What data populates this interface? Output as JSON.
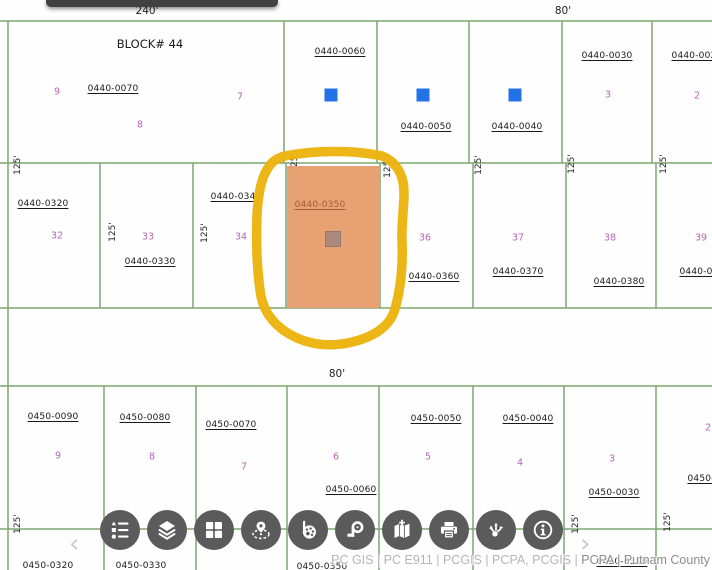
{
  "map": {
    "colors": {
      "line": "#7da671",
      "lot_number": "#b666b6",
      "structure_blue": "#2473e6",
      "highlight_fill": "#e7a173",
      "highlight_label": "#a65c36",
      "highlight_inner_square": "#aa8a7e",
      "marker_yellow": "#ebb40e",
      "toolbar_button": "#5b5b5b",
      "topbar": "#414141"
    },
    "block_label": {
      "text": "BLOCK# 44",
      "x": 150,
      "y": 44
    },
    "dimension_labels": [
      {
        "text": "240'",
        "x": 147,
        "y": 11
      },
      {
        "text": "80'",
        "x": 563,
        "y": 11
      },
      {
        "text": "80'",
        "x": 337,
        "y": 374
      }
    ],
    "tick_text": "125'",
    "ticks": [
      {
        "x": 18,
        "y": 165
      },
      {
        "x": 295,
        "y": 163
      },
      {
        "x": 388,
        "y": 168
      },
      {
        "x": 479,
        "y": 165
      },
      {
        "x": 572,
        "y": 164
      },
      {
        "x": 664,
        "y": 164
      },
      {
        "x": 113,
        "y": 232
      },
      {
        "x": 205,
        "y": 233
      },
      {
        "x": 18,
        "y": 524
      },
      {
        "x": 576,
        "y": 524
      },
      {
        "x": 668,
        "y": 522
      }
    ],
    "parcel_id_labels": [
      {
        "text": "0440-0070",
        "x": 113,
        "y": 89
      },
      {
        "text": "0440-0060",
        "x": 340,
        "y": 52
      },
      {
        "text": "0440-0050",
        "x": 426,
        "y": 127
      },
      {
        "text": "0440-0040",
        "x": 517,
        "y": 127
      },
      {
        "text": "0440-0030",
        "x": 607,
        "y": 56
      },
      {
        "text": "0440-002",
        "x": 694,
        "y": 56
      },
      {
        "text": "0440-0320",
        "x": 43,
        "y": 204
      },
      {
        "text": "0440-0330",
        "x": 150,
        "y": 262
      },
      {
        "text": "0440-0340",
        "x": 236,
        "y": 197
      },
      {
        "text": "0440-0360",
        "x": 434,
        "y": 277
      },
      {
        "text": "0440-0370",
        "x": 518,
        "y": 272
      },
      {
        "text": "0440-0380",
        "x": 619,
        "y": 282
      },
      {
        "text": "0440-03",
        "x": 699,
        "y": 272
      },
      {
        "text": "0450-0090",
        "x": 53,
        "y": 417
      },
      {
        "text": "0450-0080",
        "x": 145,
        "y": 418
      },
      {
        "text": "0450-0070",
        "x": 231,
        "y": 425
      },
      {
        "text": "0450-0060",
        "x": 351,
        "y": 490
      },
      {
        "text": "0450-0050",
        "x": 436,
        "y": 419
      },
      {
        "text": "0450-0040",
        "x": 528,
        "y": 419
      },
      {
        "text": "0450-0030",
        "x": 614,
        "y": 493
      },
      {
        "text": "0450-0",
        "x": 704,
        "y": 479
      },
      {
        "text": "0450-0320",
        "x": 48,
        "y": 566
      },
      {
        "text": "0450-0330",
        "x": 141,
        "y": 566
      },
      {
        "text": "0450-0350",
        "x": 322,
        "y": 567
      },
      {
        "text": "0450-0380",
        "x": 622,
        "y": 562
      }
    ],
    "lot_numbers": [
      {
        "text": "9",
        "x": 57,
        "y": 92
      },
      {
        "text": "7",
        "x": 240,
        "y": 97
      },
      {
        "text": "8",
        "x": 140,
        "y": 125
      },
      {
        "text": "3",
        "x": 608,
        "y": 95
      },
      {
        "text": "2",
        "x": 697,
        "y": 96
      },
      {
        "text": "32",
        "x": 57,
        "y": 236
      },
      {
        "text": "33",
        "x": 148,
        "y": 237
      },
      {
        "text": "34",
        "x": 241,
        "y": 237
      },
      {
        "text": "36",
        "x": 425,
        "y": 238
      },
      {
        "text": "37",
        "x": 518,
        "y": 238
      },
      {
        "text": "38",
        "x": 610,
        "y": 238
      },
      {
        "text": "39",
        "x": 701,
        "y": 238
      },
      {
        "text": "9",
        "x": 58,
        "y": 456
      },
      {
        "text": "8",
        "x": 152,
        "y": 457
      },
      {
        "text": "7",
        "x": 244,
        "y": 467
      },
      {
        "text": "6",
        "x": 336,
        "y": 457
      },
      {
        "text": "5",
        "x": 428,
        "y": 457
      },
      {
        "text": "4",
        "x": 520,
        "y": 463
      },
      {
        "text": "3",
        "x": 612,
        "y": 459
      },
      {
        "text": "2",
        "x": 708,
        "y": 428
      }
    ],
    "structure_squares": [
      {
        "x": 331,
        "y": 95
      },
      {
        "x": 423,
        "y": 95
      },
      {
        "x": 515,
        "y": 95
      }
    ],
    "highlighted_parcel": {
      "label": "0440-0350",
      "x": 287,
      "y": 166,
      "w": 92,
      "h": 142,
      "label_x": 33,
      "label_y": 39,
      "square_x": 46,
      "square_y": 73,
      "square_size": 14
    },
    "marker_circle_path": "M 285 156 C 315 150, 355 150, 382 156 C 392 160, 400 168, 403 182 C 406 198, 401 220, 402 242 C 403 264, 401 290, 394 312 C 388 328, 372 338, 348 343 C 322 348, 300 342, 283 330 C 270 320, 262 308, 260 290 C 257 268, 256 240, 257 215 C 258 196, 261 178, 268 168 C 273 160, 278 158, 285 156 Z",
    "lines": {
      "horizontal": [
        [
          0,
          21,
          712,
          21
        ],
        [
          0,
          163,
          712,
          163
        ],
        [
          0,
          308,
          712,
          308
        ],
        [
          0,
          386,
          712,
          386
        ],
        [
          0,
          529,
          712,
          529
        ]
      ],
      "vertical": [
        [
          8,
          21,
          8,
          570
        ],
        [
          284,
          21,
          284,
          163
        ],
        [
          377,
          21,
          377,
          163
        ],
        [
          469,
          21,
          469,
          163
        ],
        [
          562,
          21,
          562,
          163
        ],
        [
          652,
          21,
          652,
          163
        ],
        [
          100,
          163,
          100,
          308
        ],
        [
          193,
          163,
          193,
          308
        ],
        [
          286,
          163,
          286,
          308
        ],
        [
          380,
          163,
          380,
          308
        ],
        [
          473,
          163,
          473,
          308
        ],
        [
          566,
          163,
          566,
          308
        ],
        [
          656,
          163,
          656,
          308
        ],
        [
          104,
          386,
          104,
          570
        ],
        [
          196,
          386,
          196,
          570
        ],
        [
          287,
          386,
          287,
          570
        ],
        [
          379,
          386,
          379,
          570
        ],
        [
          473,
          386,
          473,
          570
        ],
        [
          564,
          386,
          564,
          570
        ],
        [
          656,
          386,
          656,
          570
        ]
      ]
    },
    "topbar": {
      "x": 46,
      "w": 232
    }
  },
  "toolbar": {
    "prev_glyph": "‹",
    "next_glyph": "›",
    "buttons": [
      {
        "name": "legend",
        "label": "Legend"
      },
      {
        "name": "layers",
        "label": "Layers"
      },
      {
        "name": "basemap",
        "label": "Basemap grid"
      },
      {
        "name": "location",
        "label": "Location"
      },
      {
        "name": "draw",
        "label": "Draw / markup"
      },
      {
        "name": "measure",
        "label": "Measure"
      },
      {
        "name": "add-map",
        "label": "Add to map"
      },
      {
        "name": "print",
        "label": "Print"
      },
      {
        "name": "share",
        "label": "Share"
      },
      {
        "name": "info",
        "label": "Information"
      }
    ]
  },
  "attribution": {
    "sources": "PC GIS | PC E911 | PCGIS | PCPA, PCGIS | ",
    "county": "PCPA | Putnam County"
  }
}
